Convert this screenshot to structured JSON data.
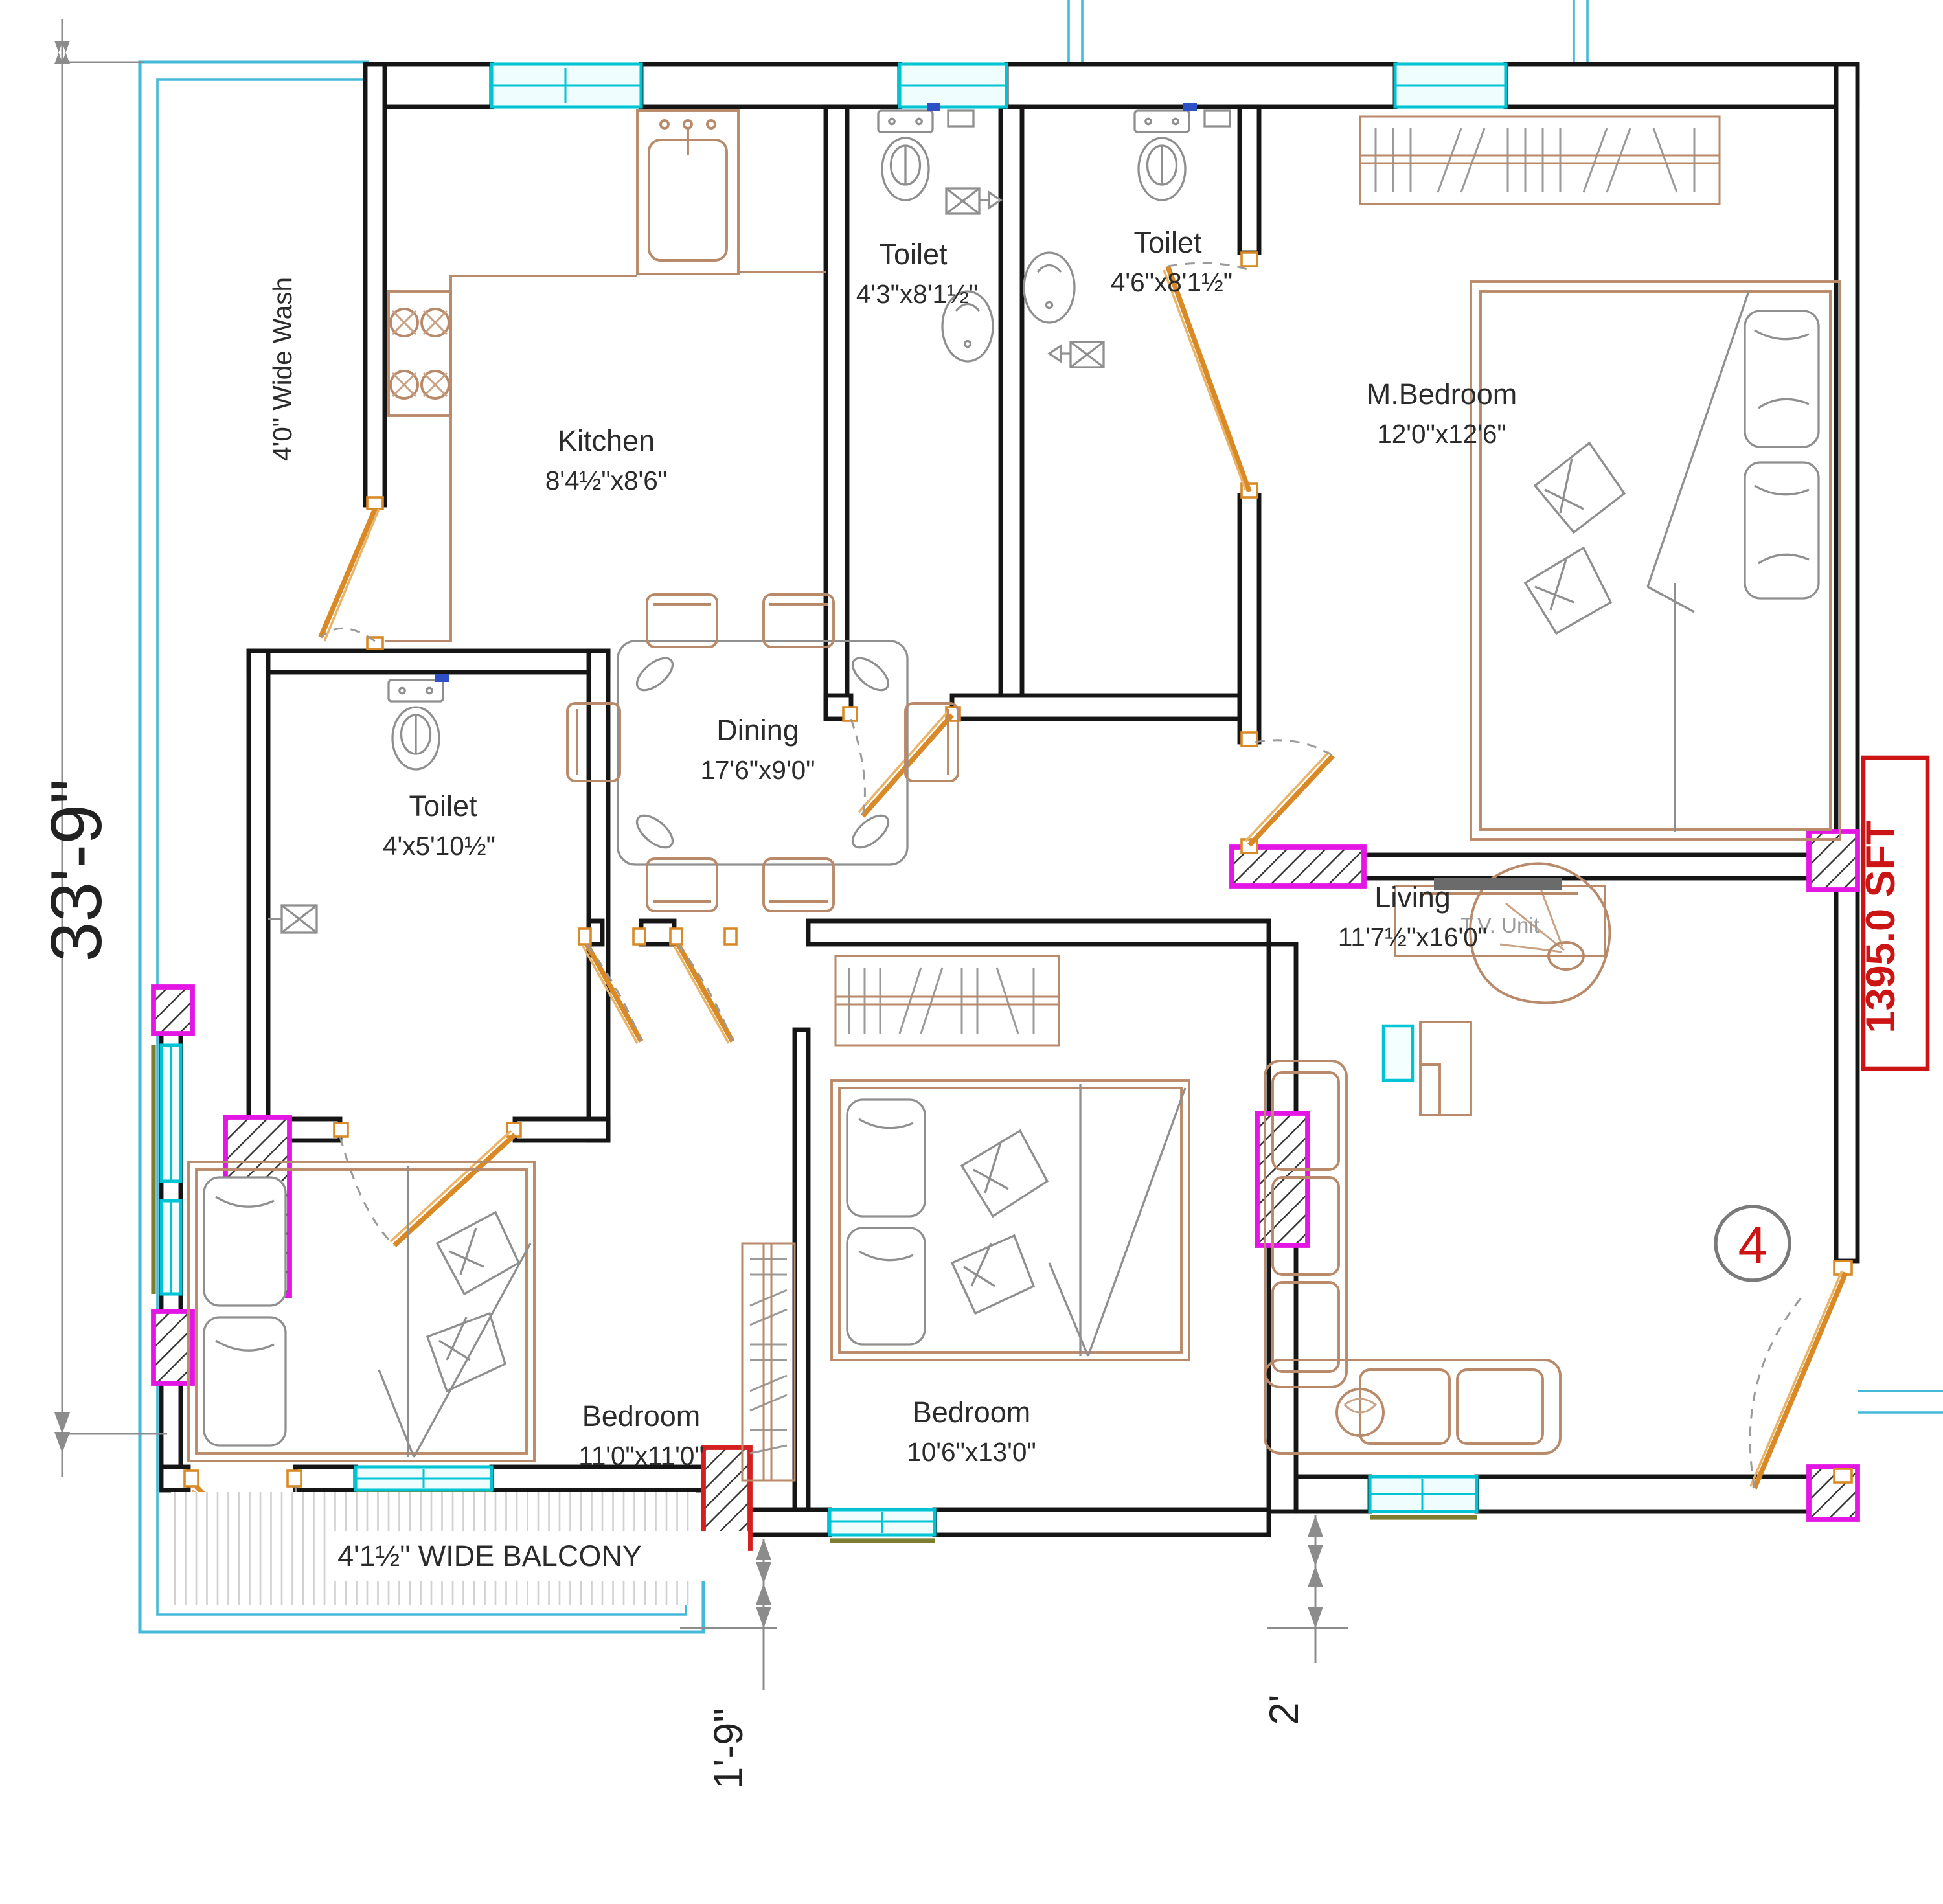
{
  "rooms": {
    "kitchen": {
      "name": "Kitchen",
      "size": "8'4½\"x8'6\""
    },
    "toilet1": {
      "name": "Toilet",
      "size": "4'3\"x8'1½\""
    },
    "toilet2": {
      "name": "Toilet",
      "size": "4'6\"x8'1½\""
    },
    "toilet3": {
      "name": "Toilet",
      "size": "4'x5'10½\""
    },
    "master_bedroom": {
      "name": "M.Bedroom",
      "size": "12'0\"x12'6\""
    },
    "dining": {
      "name": "Dining",
      "size": "17'6\"x9'0\""
    },
    "living": {
      "name": "Living",
      "size": "11'7½\"x16'0\""
    },
    "bedroom1": {
      "name": "Bedroom",
      "size": "11'0\"x11'0\""
    },
    "bedroom2": {
      "name": "Bedroom",
      "size": "10'6\"x13'0\""
    }
  },
  "annotations": {
    "balcony": "4'1½\" WIDE BALCONY",
    "wash": "4'0\" Wide Wash",
    "tv_unit": "T.V. Unit",
    "area": "1395.0 SFT",
    "unit_number": "4"
  },
  "dimensions": {
    "left_total": "33'-9\"",
    "bottom_offset": "1'-9\"",
    "right_offset": "2'"
  },
  "colors": {
    "wall": "#151515",
    "window": "#00c4d4",
    "boundary": "#45b9d8",
    "door": "#d98a26",
    "furniture": "#b98a6a",
    "column_highlight": "#e316e3",
    "column_red": "#d42020",
    "area_text": "#cc1414",
    "sill": "#7d7d2f",
    "fixture": "#8f8f8f"
  }
}
